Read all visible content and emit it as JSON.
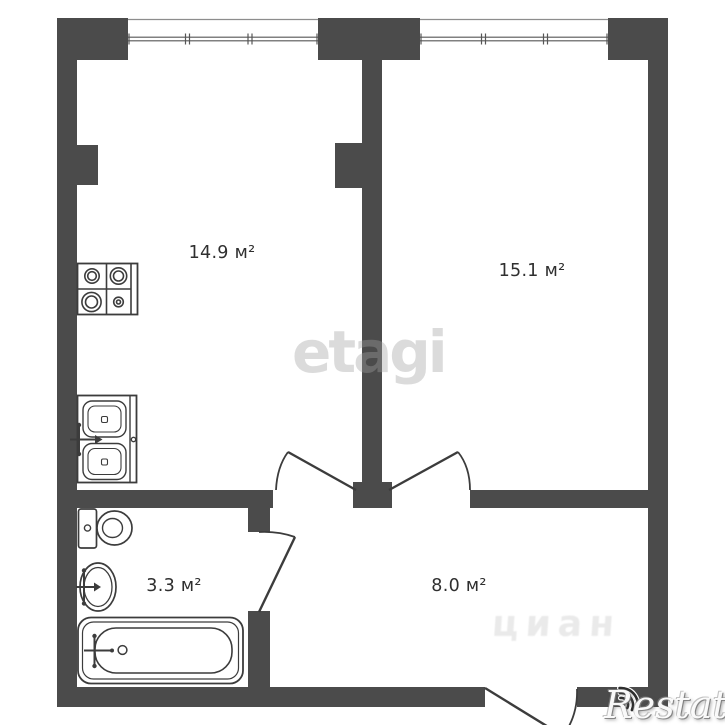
{
  "plan": {
    "rooms": [
      {
        "id": "kitchen-living-room",
        "area_label": "14.9 м²"
      },
      {
        "id": "bedroom",
        "area_label": "15.1 м²"
      },
      {
        "id": "bathroom",
        "area_label": "3.3 м²"
      },
      {
        "id": "hallway",
        "area_label": "8.0 м²"
      }
    ],
    "fixtures": [
      "stove",
      "double-sink",
      "toilet",
      "washbasin",
      "bathtub"
    ],
    "window_count": 2,
    "door_count": 4,
    "colors": {
      "wall": "#4b4b4b",
      "fixture_line": "#3c3c3c",
      "label_text": "#2f2f2f",
      "background": "#ffffff"
    }
  },
  "watermarks": {
    "center_logo": "etagi",
    "listing_site": "циан",
    "corner_logo": "Restate"
  }
}
